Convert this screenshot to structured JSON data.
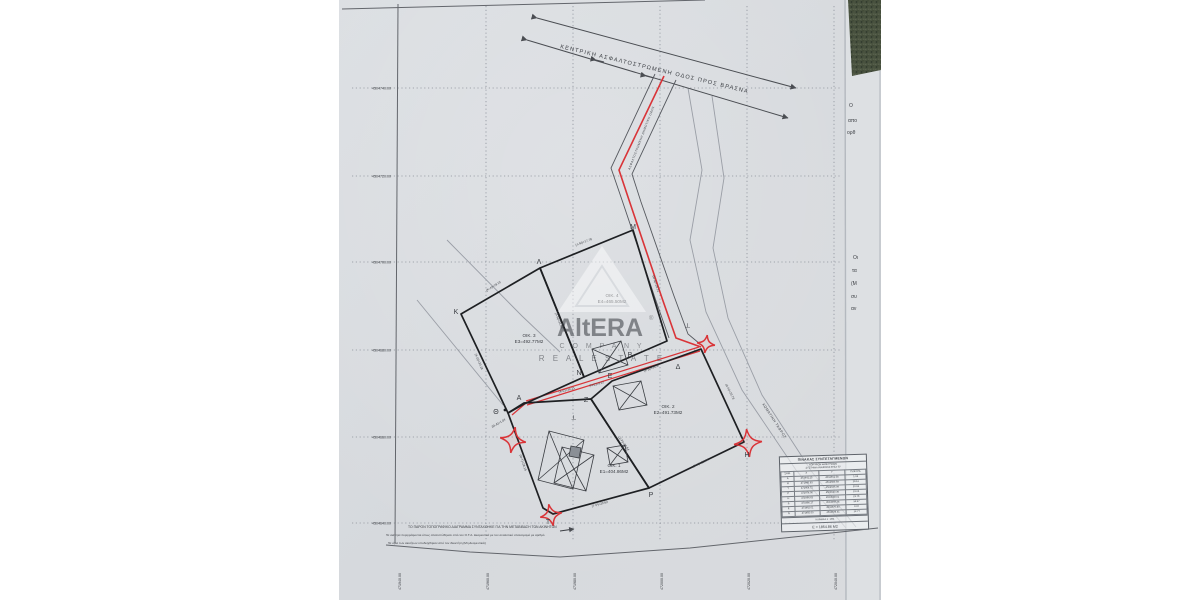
{
  "watermark": {
    "brand": "AltERA",
    "reg": "®",
    "company": "C O M P A N Y",
    "tagline": "R E A L   E S T A T E"
  },
  "roads": {
    "main_label": "ΚΕΝΤΡΙΚΗ ΑΣΦΑΛΤΟΣΤΡΩΜΕΝΗ ΟΔΟΣ ΠΡΟΣ ΒΡΑΣΝΑ",
    "branch_label": "ΑΣΦΑΛΤΟΣΤΡΩΜΕΝΗ ΔΗΜΟΤΙΚΗ ΟΔΟΣ",
    "ditch_label": "ΧΩΜΑΤΙΝΗ ΤΑΦΡΟΣ"
  },
  "axes": {
    "y": [
      "4504740.00",
      "4504720.00",
      "4504700.00",
      "4504680.00",
      "4504660.00",
      "4504640.00"
    ],
    "x": [
      "471940.00",
      "471960.00",
      "471980.00",
      "472000.00",
      "472020.00",
      "472040.00"
    ]
  },
  "parcels": [
    {
      "id": "ΟΙΚ. 1",
      "area": "Ε1=404.86Μ2"
    },
    {
      "id": "ΟΙΚ. 2",
      "area": "Ε2=491.73Μ2"
    },
    {
      "id": "ΟΙΚ. 3",
      "area": "Ε3=492.77Μ2"
    },
    {
      "id": "ΟΙΚ. 4",
      "area": "Ε4=465.50Μ2"
    }
  ],
  "vertices": [
    {
      "label": "Κ"
    },
    {
      "label": "Λ"
    },
    {
      "label": "Μ"
    },
    {
      "label": "Ν"
    },
    {
      "label": "Ε"
    },
    {
      "label": "Β"
    },
    {
      "label": "Δ"
    },
    {
      "label": "Θ"
    },
    {
      "label": "Α"
    },
    {
      "label": "Ζ"
    },
    {
      "label": "Ρ"
    },
    {
      "label": "Η"
    },
    {
      "label": "Τ"
    }
  ],
  "edges": [
    {
      "label": "(Κ-Λ)=19.15"
    },
    {
      "label": "(Λ-Μ)=17.78"
    },
    {
      "label": "(Μ-Δ)=28.21"
    },
    {
      "label": "(Κ-Θ)=33.18"
    },
    {
      "label": "(Λ-Ν)=31.08"
    },
    {
      "label": "(Α-Ε)=38.21"
    },
    {
      "label": "(Ε-Δ)=34.97"
    },
    {
      "label": "(Θ-Α)=1.04"
    },
    {
      "label": "(Δ-Η)=23.78"
    },
    {
      "label": "(Ρ-Η)=23.04"
    },
    {
      "label": "(Τ-Ρ)=20.62"
    },
    {
      "label": "(Θ-Τ)=28.16"
    },
    {
      "label": "(Ζ-Ρ)=10.64"
    },
    {
      "label": "(Ν-Ε)=9.97"
    }
  ],
  "marks": {
    "survey_tick": "⊢"
  },
  "notes": {
    "l1": "ΤΟ ΠΑΡΟΝ ΤΟΠΟΓΡΑΦΙΚΟ ΔΙΑΓΡΑΜΜΑ ΣΥΝΤΑΧΘΗΚΕ ΓΙΑ ΤΗΝ ΜΕΤΑΒΙΒΑΣΗ ΤΩΝ ΑΚΙΝΗΤΩΝ",
    "l2": "Τα ακίνητα περιγράφονται όπως αποτυπώθηκαν από τον Ο.Τ.Α. Δεσμευτικά με τον αναλυτικό υπολογισμό με αριθμό",
    "l3": "Τα όρια των ακινήτων υποδείχθηκαν από τον ιδιοκτήτη (Μη Δεσμευτικά)"
  },
  "side_text": {
    "col1": [
      "Ο",
      "απο",
      "ορθ"
    ],
    "col2": [
      "Οι",
      "τα",
      "(Μ",
      "συ",
      "αν"
    ]
  },
  "table": {
    "title": "ΠΙΝΑΚΑΣ ΣΥΝΤΕΤΑΓΜΕΝΩΝ",
    "subtitle1": "ΚΟΡΥΦΩΝ ΙΔΙΟΚΤΗΣΙΩΝ",
    "subtitle2": "ΣΥΣΤΗΜΑ ΑΝΑΦΟΡΑΣ ΕΓΣΑ '87",
    "headers": [
      "ΣΗΜ.",
      "Χ",
      "Υ",
      "ΠΛΕΥΡΑ"
    ],
    "rows": [
      [
        "Α",
        "471941.25",
        "4504661.58",
        "1.04"
      ],
      [
        "Θ",
        "471940.93",
        "4504660.59",
        "28.16"
      ],
      [
        "Τ",
        "471954.72",
        "4504636.09",
        "20.62"
      ],
      [
        "Ρ",
        "471974.90",
        "4504640.36",
        "23.04"
      ],
      [
        "Η",
        "471996.63",
        "4504648.01",
        "23.78"
      ],
      [
        "Δ",
        "471986.17",
        "4504669.38",
        "34.97"
      ],
      [
        "Ε",
        "471962.01",
        "4504676.80",
        "9.97"
      ],
      [
        "Ν",
        "471955.00",
        "4504678.31",
        "12.77"
      ]
    ],
    "footer1": "ΚΛΙΜΑΚΑ 1 : 200",
    "footer2": "Ε = 1854.86 Μ2"
  },
  "colors": {
    "red": "#d93438",
    "paper": "#d7dade",
    "line": "#55585e",
    "parcel": "#1e2023"
  }
}
